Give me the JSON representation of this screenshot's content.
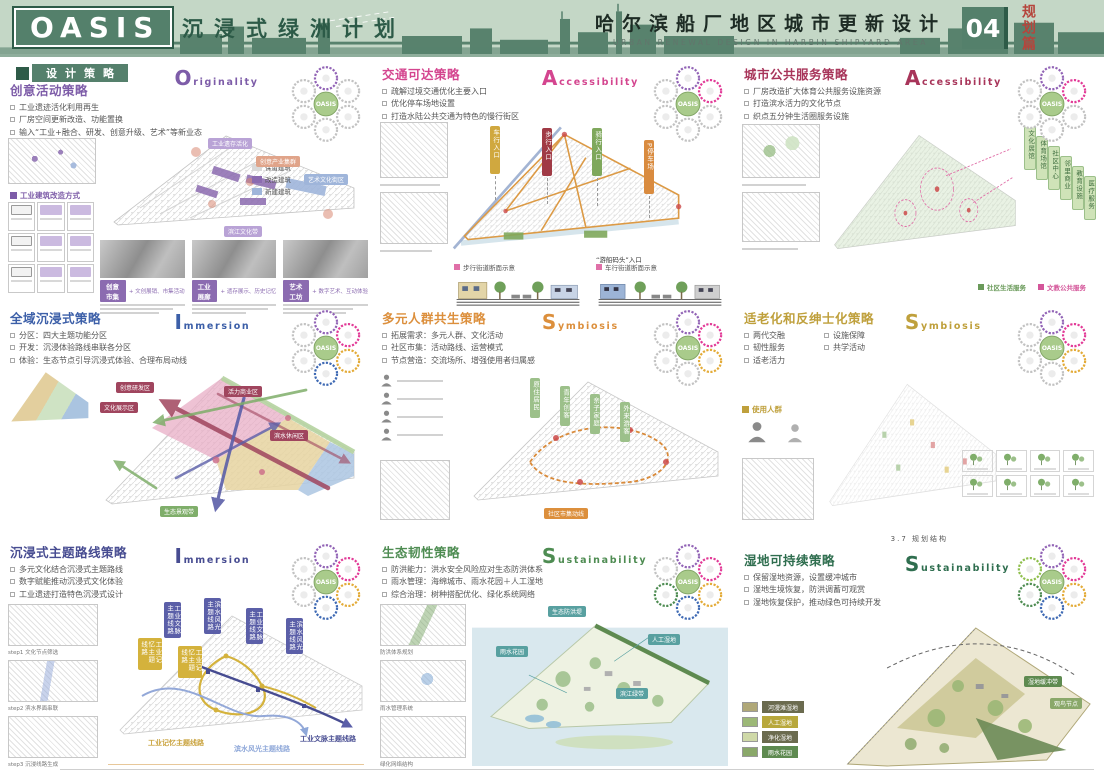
{
  "header": {
    "logo": "OASIS",
    "title_cn": "沉浸式绿洲计划",
    "title_right_cn": "哈尔滨船厂地区城市更新设计",
    "title_right_en": "URBAN RENEWAL DESIGN IN HARBIN SHIPYARD AREA",
    "page_number": "04",
    "section_tag": "规划篇",
    "colors": {
      "band": "#c4d7c6",
      "brand_green": "#54806b",
      "dark_green": "#2e5b48",
      "tag_red": "#b5453c"
    }
  },
  "section_label": "设计策略",
  "flower_center": "OASIS",
  "panels": [
    {
      "accent": "#7d5ca8",
      "strategy": "创意活动策略",
      "keyword": "Originality",
      "bullets": [
        "工业遗迹活化利用再生",
        "厂房空间更新改造、功能置换",
        "输入“工业+融合、研发、创意升级、艺术”等新业态"
      ],
      "petals": [
        "#9264b6",
        "#c2c2c2",
        "#c2c2c2",
        "#c2c2c2",
        "#c2c2c2",
        "#c2c2c2"
      ],
      "sub_label": "工业建筑改造方式",
      "legend": [
        {
          "label": "保留建筑",
          "color": "#d9d9d9"
        },
        {
          "label": "改造建筑",
          "color": "#8b6bb0"
        },
        {
          "label": "新建建筑",
          "color": "#9fb5da"
        }
      ],
      "map_tags": [
        "工业遗存活化",
        "创意产业集群",
        "艺术文化街区",
        "滨江文化带"
      ],
      "cards": [
        {
          "tag": "创意市集",
          "note": "+ 文创展销、市集活动"
        },
        {
          "tag": "工业展廊",
          "note": "+ 遗存展示、历史记忆"
        },
        {
          "tag": "艺术工坊",
          "note": "+ 数字艺术、互动体验"
        }
      ]
    },
    {
      "accent": "#d4458f",
      "strategy": "交通可达策略",
      "keyword": "Accessibility",
      "bullets": [
        "疏解过境交通优化主要入口",
        "优化停车场地设置",
        "打造水陆公共交通为特色的慢行街区"
      ],
      "petals": [
        "#9264b6",
        "#e23a97",
        "#c2c2c2",
        "#c2c2c2",
        "#c2c2c2",
        "#c2c2c2"
      ],
      "banner_tags": [
        {
          "text": "车行入口",
          "color": "#d0a83f"
        },
        {
          "text": "步行入口",
          "color": "#a03a45"
        },
        {
          "text": "骑行入口",
          "color": "#7fa85c"
        },
        {
          "text": "P停车场",
          "color": "#d98b3f"
        }
      ],
      "note": "“游船码头”入口",
      "section_labels": [
        "步行街道断面示意",
        "车行街道断面示意"
      ]
    },
    {
      "accent": "#a8355a",
      "strategy": "城市公共服务策略",
      "keyword": "Accessibility",
      "bullets": [
        "厂房改造扩大体育公共服务设施资源",
        "打造滨水活力的文化节点",
        "织点五分钟生活圈服务设施"
      ],
      "petals": [
        "#9264b6",
        "#e23a97",
        "#c2c2c2",
        "#c2c2c2",
        "#c2c2c2",
        "#c2c2c2"
      ],
      "service_bars": [
        "文化展馆",
        "体育场馆",
        "社区中心",
        "邻里商业",
        "教育设施",
        "医疗服务"
      ],
      "bottom_labels": [
        {
          "text": "社区生活服务",
          "color": "#6a9a5a"
        },
        {
          "text": "文教公共服务",
          "color": "#d4569a"
        }
      ]
    },
    {
      "accent": "#3c5fa8",
      "strategy": "全域沉浸式策略",
      "keyword": "Immersion",
      "bullets": [
        "分区：四大主题功能分区",
        "开发：沉浸体验路线串联各分区",
        "体验：生态节点引导沉浸式体验、合理布局动线"
      ],
      "petals": [
        "#9264b6",
        "#e23a97",
        "#e3ab38",
        "#3f6ab4",
        "#c2c2c2",
        "#c2c2c2"
      ],
      "map_tags": [
        "创意研发区",
        "文化展示区",
        "活力商业区",
        "滨水休闲区",
        "生态景观带"
      ]
    },
    {
      "accent": "#dc8f3c",
      "strategy": "多元人群共生策略",
      "keyword": "Symbiosis",
      "bullets": [
        "拓展需求：多元人群、文化活动",
        "社区市集：活动路线、运营模式",
        "节点营造：交流场所、增强使用者归属感"
      ],
      "petals": [
        "#9264b6",
        "#e23a97",
        "#e3ab38",
        "#c2c2c2",
        "#c2c2c2",
        "#c2c2c2"
      ],
      "people_bars": [
        "原住居民",
        "青年创客",
        "亲子家庭",
        "外来游客"
      ],
      "note": "社区市集动线"
    },
    {
      "accent": "#bfa03c",
      "strategy": "适老化和反绅士化策略",
      "keyword": "Symbiosis",
      "bullets": [
        "两代交融",
        "设施保障",
        "韧性服务",
        "共学活动",
        "适老活力"
      ],
      "petals": [
        "#9264b6",
        "#e23a97",
        "#e3ab38",
        "#c2c2c2",
        "#c2c2c2",
        "#c2c2c2"
      ],
      "sub_label": "使用人群"
    },
    {
      "accent": "#474c91",
      "strategy": "沉浸式主题路线策略",
      "keyword": "Immersion",
      "bullets": [
        "多元文化结合沉浸式主题路线",
        "数字赋能推动沉浸式文化体验",
        "工业遗迹打造特色沉浸式设计"
      ],
      "petals": [
        "#9264b6",
        "#e23a97",
        "#e3ab38",
        "#3f6ab4",
        "#c2c2c2",
        "#c2c2c2"
      ],
      "route_labels": [
        {
          "text": "工业记忆主题线路",
          "color": "#c9a23c"
        },
        {
          "text": "滨水风光主题线路",
          "color": "#8fa8d9"
        },
        {
          "text": "工业文脉主题线路",
          "color": "#474c91"
        }
      ],
      "step_captions": [
        "step1 文化节点筛选",
        "step2 滨水界面串联",
        "step3 沉浸线路生成"
      ]
    },
    {
      "accent": "#4e8c52",
      "strategy": "生态韧性策略",
      "keyword": "Sustainability",
      "bullets": [
        "防洪能力：洪水安全风险应对生态防洪体系",
        "雨水管理：海绵城市、雨水花园＋人工湿地",
        "综合治理：树种搭配优化、绿化系统网络"
      ],
      "petals": [
        "#9264b6",
        "#e23a97",
        "#e3ab38",
        "#3f6ab4",
        "#4e8c52",
        "#c2c2c2"
      ],
      "map_tags": [
        "生态防洪堤",
        "雨水花园",
        "人工湿地",
        "滨江绿带"
      ],
      "thumb_captions": [
        "防洪体系规划",
        "雨水管理系统",
        "绿化网络结构"
      ]
    },
    {
      "accent": "#2f6e4f",
      "strategy": "湿地可持续策略",
      "keyword": "Sustainability",
      "note_above": "3.7 规划结构",
      "bullets": [
        "保留湿地资源，设置缓冲城市",
        "湿地生境恢复，防洪调蓄可观赏",
        "湿地恢复保护，推动绿色可持续开发"
      ],
      "petals": [
        "#9264b6",
        "#e23a97",
        "#e3ab38",
        "#3f6ab4",
        "#4e8c52",
        "#8fbf4d"
      ],
      "legend_rows": [
        {
          "label": "河漫滩湿地",
          "color": "#b0a878"
        },
        {
          "label": "人工湿地",
          "color": "#9cb877"
        },
        {
          "label": "净化湿地",
          "color": "#cfd9a8"
        },
        {
          "label": "雨水花园",
          "color": "#8aa86a"
        }
      ],
      "map_tags": [
        "湿地缓冲带",
        "观鸟节点"
      ]
    }
  ]
}
